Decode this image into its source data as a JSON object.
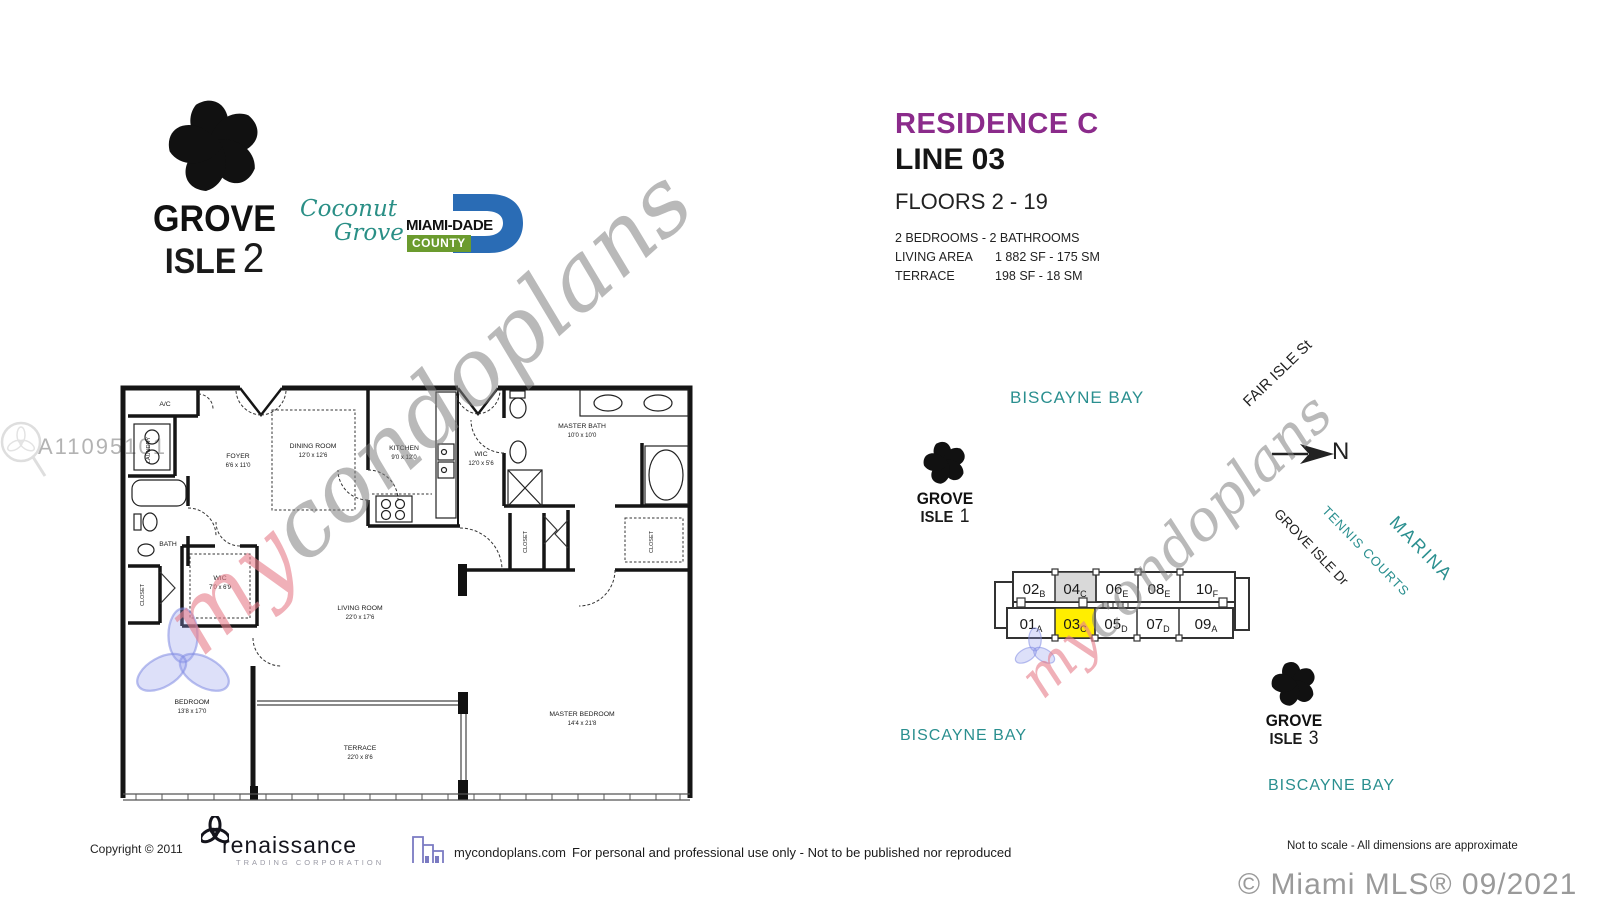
{
  "branding": {
    "grove_isle_2": {
      "word1": "GROVE",
      "word2": "ISLE",
      "number": "2"
    },
    "grove_isle_1": {
      "word1": "GROVE",
      "word2": "ISLE",
      "number": "1"
    },
    "grove_isle_3": {
      "word1": "GROVE",
      "word2": "ISLE",
      "number": "3"
    },
    "coconut_grove": {
      "word1": "Coconut",
      "word2": "Grove"
    },
    "miami_dade": {
      "name": "MIAMI-DADE",
      "county": "COUNTY"
    }
  },
  "header": {
    "residence": "RESIDENCE C",
    "line": "LINE 03",
    "floors": "FLOORS 2 - 19",
    "bed_bath": "2 BEDROOMS - 2 BATHROOMS",
    "living_area_label": "LIVING AREA",
    "living_area_value": "1 882 SF - 175 SM",
    "terrace_label": "TERRACE",
    "terrace_value": "198 SF -   18 SM"
  },
  "colors": {
    "accent_purple": "#8b2b8b",
    "teal": "#2a8f8f",
    "highlight_yellow": "#ffee00",
    "shaded_gray": "#d9d9d9",
    "miami_dade_blue": "#2a6cb5",
    "county_green": "#6b9b2e",
    "watermark_gray": "#808080",
    "watermark_pink": "#e7808c",
    "watermark_blue": "#96a0e6"
  },
  "watermarks": {
    "mls_number": "A11095101",
    "script_my": "my",
    "script_rest": "condoplans"
  },
  "floor_plan": {
    "rooms": {
      "ac": {
        "name": "A/C"
      },
      "laundry": {
        "name": "LAUNDRY"
      },
      "foyer": {
        "name": "FOYER",
        "dims": "6'6 x 11'0"
      },
      "dining": {
        "name": "DINING ROOM",
        "dims": "12'0 x 12'6"
      },
      "kitchen": {
        "name": "KITCHEN",
        "dims": "9'0 x 12'0"
      },
      "wic_master": {
        "name": "WIC",
        "dims": "12'0 x 5'6"
      },
      "master_bath": {
        "name": "MASTER BATH",
        "dims": "10'0 x 10'0"
      },
      "bath": {
        "name": "BATH"
      },
      "closet_hall": {
        "name": "CLOSET"
      },
      "wic_bedroom": {
        "name": "WIC",
        "dims": "7'0 x 6'9"
      },
      "closet_a": {
        "name": "CLOSET"
      },
      "closet_b": {
        "name": "CLOSET"
      },
      "living": {
        "name": "LIVING ROOM",
        "dims": "22'0 x 17'6"
      },
      "bedroom": {
        "name": "BEDROOM",
        "dims": "13'8 x 17'0"
      },
      "master_bedroom": {
        "name": "MASTER BEDROOM",
        "dims": "14'4 x 21'8"
      },
      "terrace": {
        "name": "TERRACE",
        "dims": "22'0 x 8'6"
      }
    }
  },
  "site_map": {
    "bay_top": "BISCAYNE BAY",
    "bay_left": "BISCAYNE BAY",
    "bay_right": "BISCAYNE BAY",
    "fair_isle": "FAIR ISLE St",
    "grove_isle_dr": "GROVE ISLE Dr",
    "tennis": "TENNIS COURTS",
    "marina": "MARINA",
    "north": "N",
    "building": {
      "top_row": [
        {
          "num": "02",
          "letter": "B"
        },
        {
          "num": "04",
          "letter": "C"
        },
        {
          "num": "06",
          "letter": "E"
        },
        {
          "num": "08",
          "letter": "E"
        },
        {
          "num": "10",
          "letter": "F"
        }
      ],
      "bottom_row": [
        {
          "num": "01",
          "letter": "A"
        },
        {
          "num": "03",
          "letter": "C"
        },
        {
          "num": "05",
          "letter": "D"
        },
        {
          "num": "07",
          "letter": "D"
        },
        {
          "num": "09",
          "letter": "A"
        }
      ],
      "highlighted_unit": "03C",
      "shaded_unit": "04C"
    }
  },
  "footer": {
    "copyright": "Copyright ©   2011",
    "renaissance": "renaissance",
    "renaissance_sub": "TRADING CORPORATION",
    "site": "mycondoplans.com",
    "disclaimer": "For personal and professional use only - Not to be published nor reproduced",
    "scale_note": "Not to scale - All dimensions are approximate",
    "mls_credit": "© Miami MLS® 09/2021"
  }
}
